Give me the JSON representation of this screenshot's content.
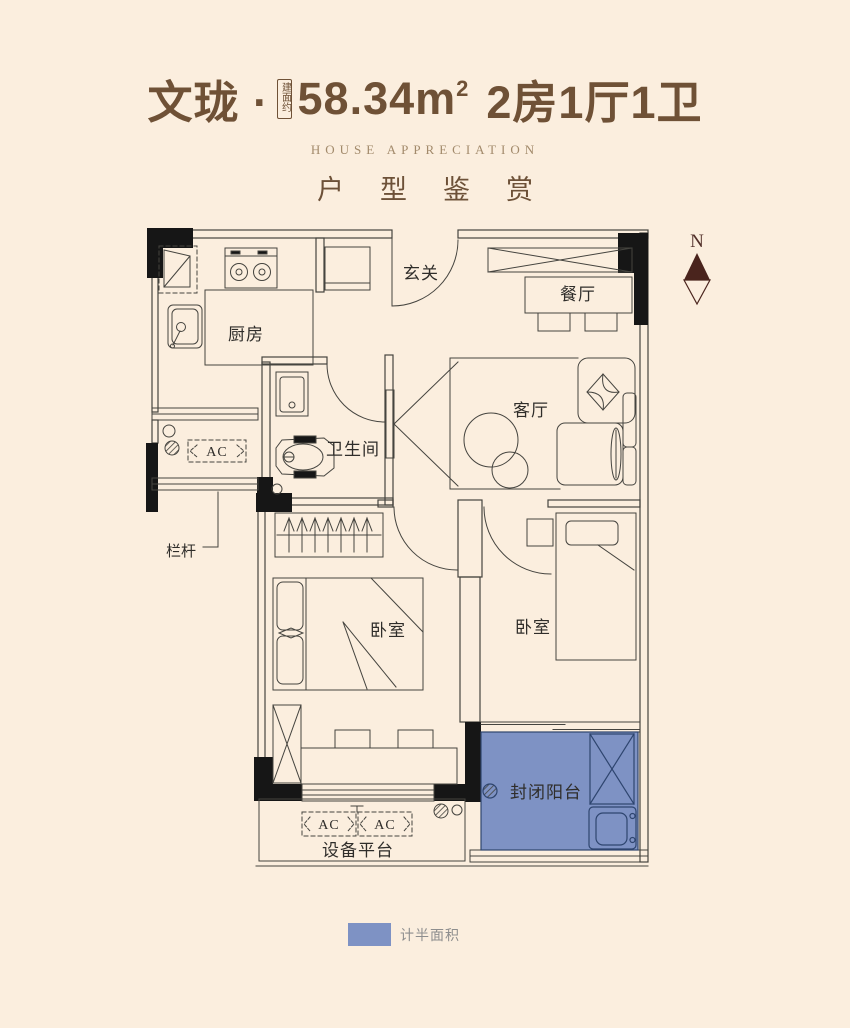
{
  "title": {
    "project": "文珑 ·",
    "area_prefix": "建面约",
    "area": "58.34m",
    "area_exponent": "2",
    "layout": "2房1厅1卫",
    "subtitle_en": "HOUSE APPRECIATION",
    "subtitle_cn": "户型鉴赏"
  },
  "plan": {
    "north": "N",
    "labels": {
      "kitchen": "厨房",
      "entry": "玄关",
      "dining": "餐厅",
      "living": "客厅",
      "bathroom": "卫生间",
      "bedroom_left": "卧室",
      "bedroom_right": "卧室",
      "railing": "栏杆",
      "balcony": "封闭阳台",
      "equipment_platform": "设备平台",
      "ac_left": "AC",
      "ac_platform_1": "AC",
      "ac_platform_2": "AC"
    }
  },
  "legend": {
    "half_area": "计半面积"
  },
  "colors": {
    "background": "#fbeede",
    "title_brown": "#6f5136",
    "subtitle_tan": "#a28a6b",
    "plan_line": "#45443f",
    "pillar_black": "#161616",
    "half_area_blue": "#7e92c4",
    "balcony_line": "#2e456f",
    "north_arrow": "#4a241d"
  }
}
